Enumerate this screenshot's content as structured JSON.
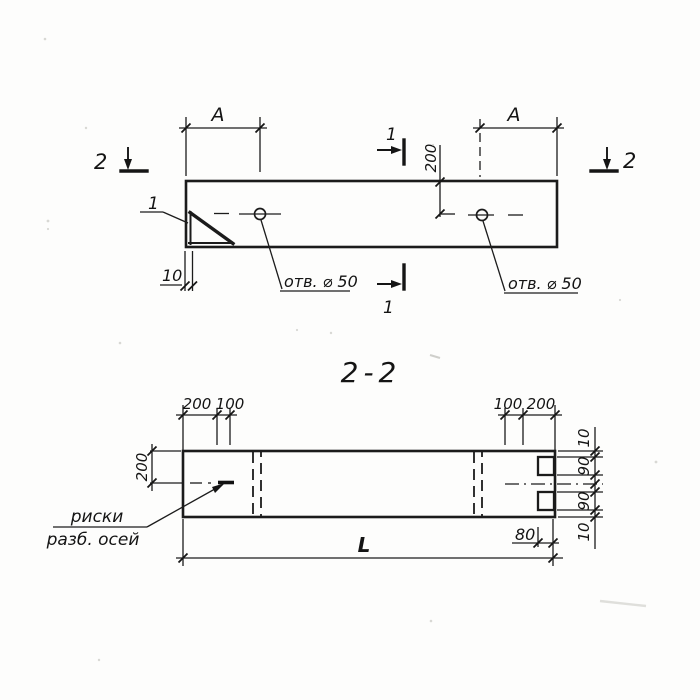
{
  "plan": {
    "dim_a_left": "A",
    "dim_a_right": "A",
    "dim_200": "200",
    "dim_10": "10",
    "hole_left": "отв. ⌀ 50",
    "hole_right": "отв. ⌀ 50",
    "detail_1": "1",
    "sec1_top": "1",
    "sec1_bottom": "1",
    "sec2_left": "2",
    "sec2_right": "2"
  },
  "section": {
    "title": "2-2",
    "dim_left_200": "200",
    "top_left": [
      "200",
      "100"
    ],
    "top_right": [
      "100",
      "200"
    ],
    "right_chain": [
      "10",
      "90",
      "90",
      "10"
    ],
    "dim_80": "80",
    "dim_len": "L",
    "note_line1": "риски",
    "note_line2": "разб. осей"
  }
}
